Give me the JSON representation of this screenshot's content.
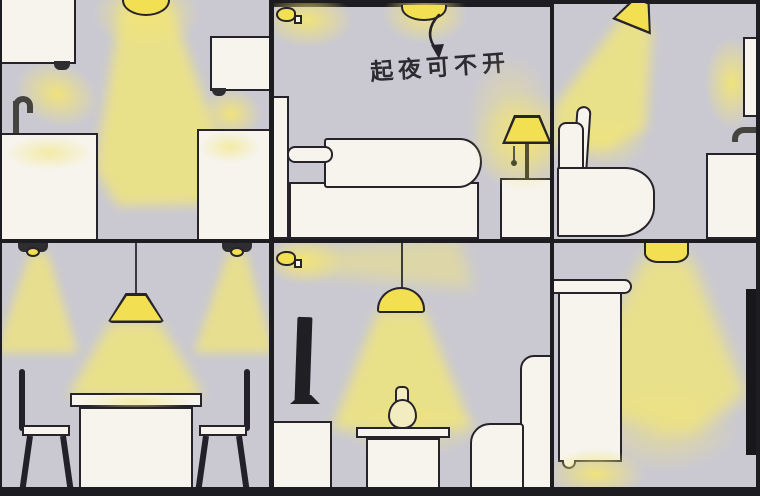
{
  "annotation": {
    "text": "起夜可不开"
  },
  "colors": {
    "wall": "#cac9d2",
    "furniture": "#f6f4ec",
    "outline": "#26242a",
    "lamp": "#f2df52",
    "beam": "#ece284",
    "dark_fixture": "#2e2d30",
    "frame": "#1d1c20",
    "glow": "#f2e478"
  },
  "panels": [
    {
      "id": "kitchen",
      "objects": [
        "upper-cabinet-left",
        "under-cabinet-light-left",
        "ceiling-dome-light",
        "upper-cabinet-right",
        "under-cabinet-light-right",
        "faucet",
        "sink-counter-left",
        "counter-right"
      ]
    },
    {
      "id": "bedroom",
      "objects": [
        "ceiling-dome-light",
        "wall-night-light",
        "arrow-to-ceiling-light",
        "annotation-text",
        "headboard",
        "pillow",
        "duvet",
        "bed-base",
        "nightstand",
        "bedside-lamp"
      ]
    },
    {
      "id": "bathroom",
      "objects": [
        "angled-pendant-light",
        "toilet",
        "mirror",
        "mirror-light",
        "faucet",
        "vanity"
      ]
    },
    {
      "id": "dining-room",
      "objects": [
        "ceiling-spotlight-left",
        "ceiling-spotlight-right",
        "pendant-lamp",
        "dining-table",
        "chair-left",
        "chair-right"
      ]
    },
    {
      "id": "living-room",
      "objects": [
        "wall-night-light",
        "pendant-lamp",
        "tv",
        "tv-cabinet",
        "side-table",
        "vase",
        "armchair"
      ]
    },
    {
      "id": "hallway",
      "objects": [
        "cylinder-pendant-light",
        "wardrobe",
        "wardrobe-knob",
        "floor-night-light",
        "wall-mounted-tv"
      ]
    }
  ]
}
